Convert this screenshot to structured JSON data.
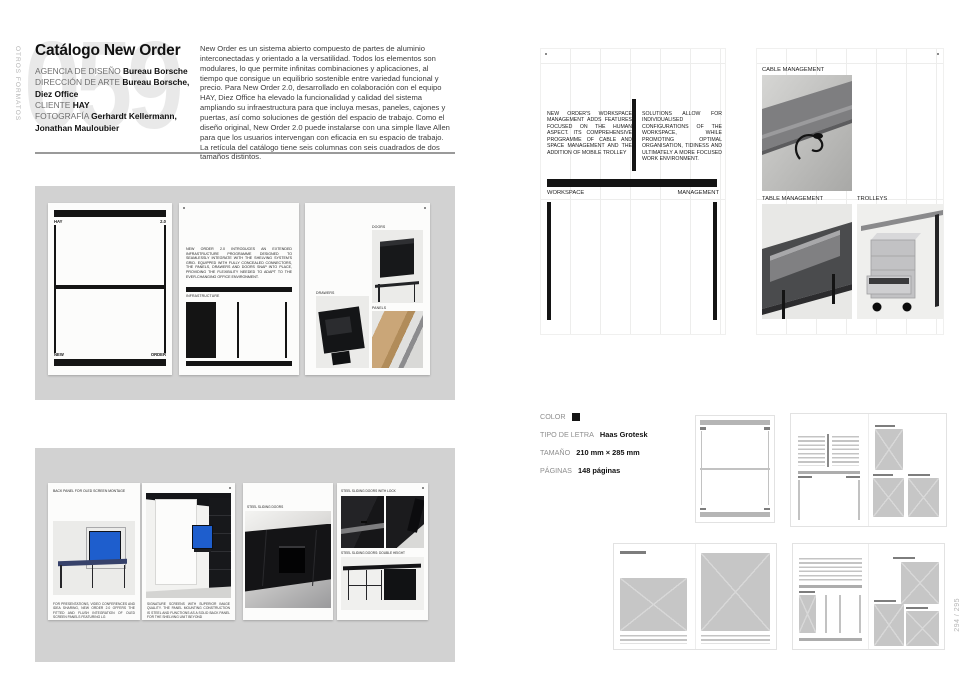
{
  "page": {
    "section_label": "OTROS FORMATOS",
    "project_number": "059",
    "folio": "294 / 295"
  },
  "colors": {
    "screen_blue": "#1e5ecd",
    "panel_gray": "#d2d2d2",
    "ink": "#141414",
    "number_gray": "#e9e9e9"
  },
  "header": {
    "title": "Catálogo New Order",
    "credits": [
      {
        "label": "AGENCIA DE DISEÑO",
        "value": "Bureau Borsche"
      },
      {
        "label": "DIRECCIÓN DE ARTE",
        "value": "Bureau Borsche, Diez Office"
      },
      {
        "label": "CLIENTE",
        "value": "HAY"
      },
      {
        "label": "FOTOGRAFÍA",
        "value": "Gerhardt Kellermann, Jonathan Mauloubier"
      }
    ],
    "intro": "New Order es un sistema abierto compuesto de partes de aluminio interconectadas y orientado a la versatilidad. Todos los elementos son modulares, lo que permite infinitas combinaciones y aplicaciones, al tiempo que consigue un equilibrio sostenible entre variedad funcional y precio. Para New Order 2.0, desarrollado en colaboración con el equipo HAY, Diez Office ha elevado la funcionalidad y calidad del sistema ampliando su infraestructura para que incluya mesas, paneles, cajones y puertas, así como soluciones de gestión del espacio de trabajo. Como el diseño original, New Order 2.0 puede instalarse con una simple llave Allen para que los usuarios intervengan con eficacia en su espacio de trabajo. La retícula del catálogo tiene seis columnas con seis cuadrados de dos tamaños distintos."
  },
  "specs": {
    "color_label": "COLOR",
    "typeface_label": "TIPO DE LETRA",
    "typeface_value": "Haas Grotesk",
    "size_label": "TAMAÑO",
    "size_value": "210 mm × 285 mm",
    "pages_label": "PÁGINAS",
    "pages_value": "148 páginas"
  },
  "spread_cover": {
    "brand_left": "HAY",
    "version": "2.0",
    "word_left": "NEW",
    "word_right": "ORDER",
    "page2_text": "NEW ORDER 2.0 INTRODUCES AN EXTENDED INFRASTRUCTURE PROGRAMME DESIGNED TO SEAMLESSLY INTEGRATE WITH THE SHELVING SYSTEM'S GRID. EQUIPPED WITH FULLY CONCEALED CONNECTORS, THE PANELS, DRAWERS AND DOORS SNAP INTO PLACE, PROVIDING THE FLEXIBILITY NEEDED TO ADAPT TO THE EVER-CHANGING OFFICE ENVIRONMENT.",
    "page2_label": "INFRASTRUCTURE",
    "page3_labels": {
      "doors": "DOORS",
      "drawers": "DRAWERS",
      "panels": "PANELS"
    }
  },
  "spread_workspace": {
    "col1": "NEW ORDER'S WORKSPACE MANAGEMENT ADDS FEATURES FOCUSED ON THE HUMAN ASPECT. ITS COMPREHENSIVE PROGRAMME OF CABLE AND SPACE MANAGEMENT AND THE ADDITION OF MOBILE TROLLEY",
    "col2": "SOLUTIONS ALLOW FOR INDIVIDUALISED CONFIGURATIONS OF THE WORKSPACE, WHILE PROMOTING OPTIMAL ORGANISATION, TIDINESS AND ULTIMATELY A MORE FOCUSED WORK ENVIRONMENT.",
    "label_left": "WORKSPACE",
    "label_right": "MANAGEMENT",
    "cable_label": "CABLE MANAGEMENT",
    "table_label": "TABLE MANAGEMENT",
    "trolleys_label": "TROLLEYS"
  },
  "spread_oled": {
    "page1_header": "BACK PANEL FOR OLED SCREEN MONTAGE",
    "page1_caption": "FOR PRESENTATIONS, VIDEO CONFERENCES AND IDEA SHARING, NEW ORDER 2.0 OFFERS THE FITTED AND FLUSH INTEGRATION OF OLED SCREEN PANELS FEATURING LG",
    "page2_caption": "SIGNATURE SCREENS WITH SUPERIOR IMAGE QUALITY. THE PANEL MOUNTING CONSTRUCTION IS STEEL AND FUNCTIONS AS A SOLID BACK PANEL FOR THE SHELVING UNIT BEYOND",
    "page3_label": "STEEL SLIDING DOORS",
    "page4_label_top": "STEEL SLIDING DOORS WITH LOCK",
    "page4_label_bottom": "STEEL SLIDING DOORS: DOUBLE HEIGHT"
  }
}
